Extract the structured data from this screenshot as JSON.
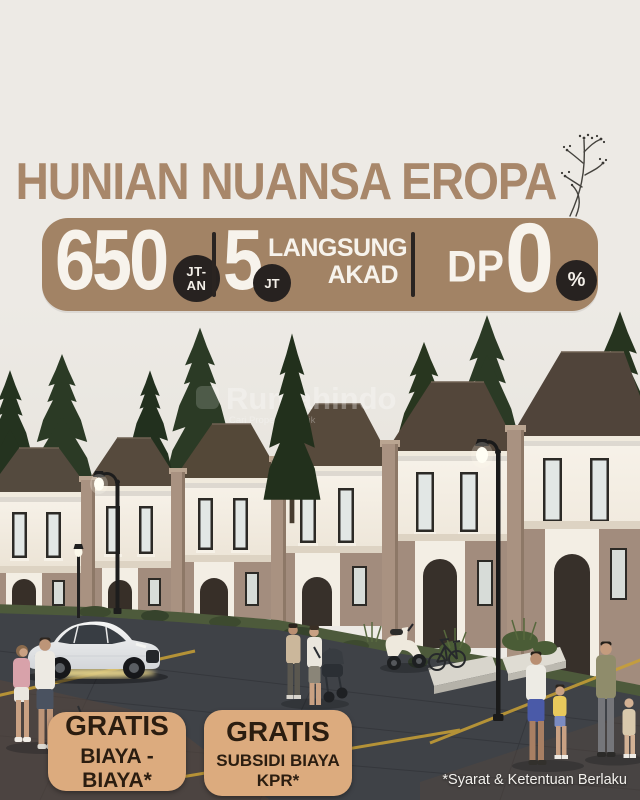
{
  "header": {
    "title": "HUNIAN NUANSA EROPA"
  },
  "offer_banner": {
    "price": {
      "value": "650",
      "unit_top": "JT-",
      "unit_bottom": "AN"
    },
    "booking": {
      "value": "5",
      "unit": "JT"
    },
    "akad": {
      "line1": "LANGSUNG",
      "line2": "AKAD"
    },
    "dp": {
      "label": "DP",
      "value": "0",
      "unit": "%"
    }
  },
  "promo_badges": [
    {
      "title": "GRATIS",
      "subtitle": "BIAYA - BIAYA*"
    },
    {
      "title": "GRATIS",
      "subtitle": "SUBSIDI BIAYA KPR*"
    }
  ],
  "watermark": {
    "brand": "Rumahindo",
    "tagline": "Cari Properti Terbaik"
  },
  "footnote": "*Syarat & Ketentuan Berlaku",
  "colors": {
    "background": "#edeae5",
    "title": "#a8876a",
    "banner": "#a28365",
    "banner_text": "#f7f3ec",
    "dark_circle": "#272220",
    "badge": "#dcab7e",
    "badge_text": "#2b1d10",
    "roof": "#56493c",
    "road": "#3f4247",
    "road_marking": "#c9a035"
  },
  "scene": {
    "icons": [
      "conifer-tree-icon",
      "townhouse-icon",
      "street-lamp-icon",
      "sedan-car-icon",
      "scooter-icon",
      "bicycle-icon",
      "stroller-icon",
      "pedestrian-figure-icon",
      "planter-box-icon",
      "branch-decoration-icon"
    ]
  }
}
